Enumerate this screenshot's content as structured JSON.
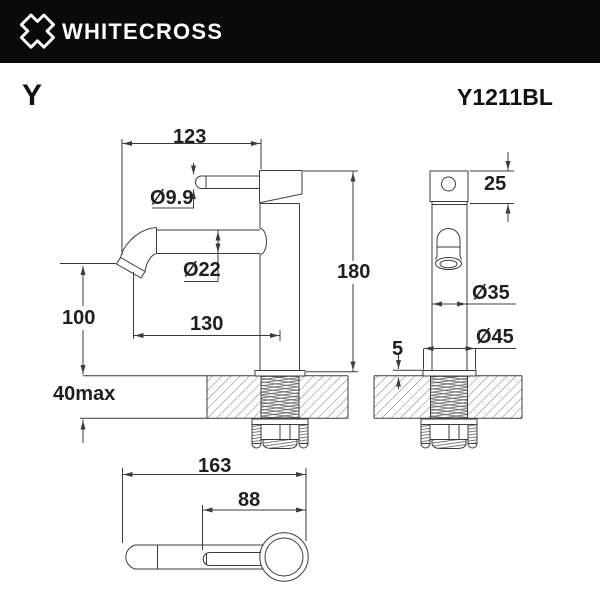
{
  "header": {
    "brand": "WHITECROSS",
    "logo_icon": "whitecross-x-logo"
  },
  "product": {
    "series": "Y",
    "model": "Y1211BL"
  },
  "drawing": {
    "side_view_dims": {
      "overall_width": "123",
      "handle_diameter": "Ø9.9",
      "spout_diameter": "Ø22",
      "spout_reach": "130",
      "spout_outlet_height": "100",
      "deck_thickness_max": "40max",
      "total_height": "180"
    },
    "front_view_dims": {
      "top_cap_height": "25",
      "body_diameter": "Ø35",
      "base_diameter": "Ø45",
      "base_lip_height": "5"
    },
    "top_view_dims": {
      "overall_length": "163",
      "handle_length": "88"
    },
    "colors": {
      "header_bg": "#0a0a0a",
      "header_fg": "#ffffff",
      "line": "#3c3c3c",
      "text": "#1f1f1f"
    }
  }
}
